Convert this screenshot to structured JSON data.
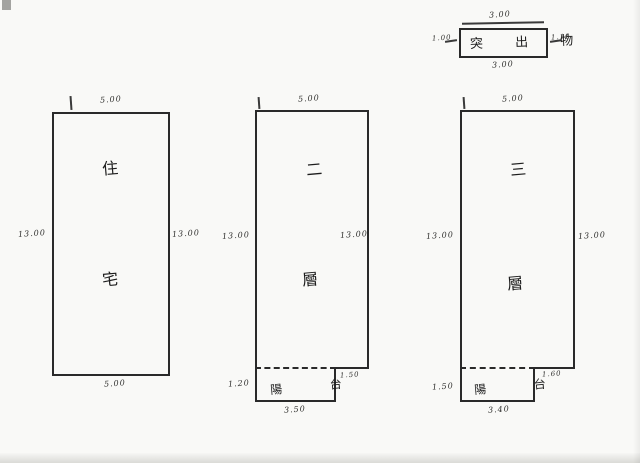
{
  "page": {
    "ink_color": "#2a2a2a",
    "paper_color": "#f9f9f7"
  },
  "protrusion_box": {
    "label": "突 出 物",
    "dim_top": "3.00",
    "dim_bottom": "3.00",
    "dim_left": "1.00",
    "dim_right": "1.10"
  },
  "units": [
    {
      "id": "residence",
      "chars": [
        "住",
        "宅"
      ],
      "dim_top": "5.00",
      "dim_bottom": "5.00",
      "dim_left": "13.00",
      "dim_right": "13.00"
    },
    {
      "id": "second-floor",
      "chars": [
        "二",
        "層"
      ],
      "dim_top": "5.00",
      "dim_left": "13.00",
      "dim_right": "13.00",
      "balcony": {
        "label": "陽 台",
        "dim_left": "1.20",
        "dim_bottom": "3.50",
        "dim_right": "1.50"
      }
    },
    {
      "id": "third-floor",
      "chars": [
        "三",
        "層"
      ],
      "dim_top": "5.00",
      "dim_left": "13.00",
      "dim_right": "13.00",
      "balcony": {
        "label": "陽 台",
        "dim_left": "1.50",
        "dim_bottom": "3.40",
        "dim_right": "1.60"
      }
    }
  ]
}
